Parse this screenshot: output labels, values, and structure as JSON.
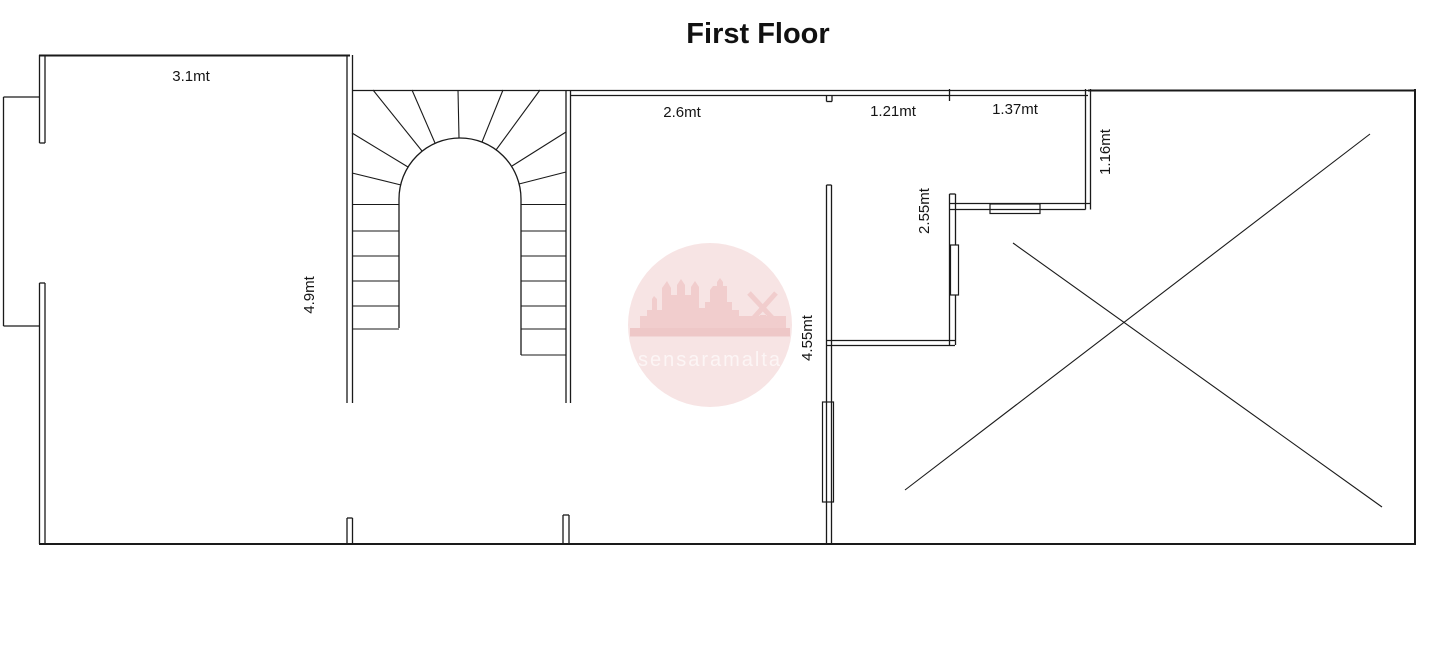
{
  "title": "First Floor",
  "plan": {
    "dimensions": {
      "left_room_width": "3.1mt",
      "left_room_height": "4.9mt",
      "middle_room_width": "2.6mt",
      "top_hall_width": "1.21mt",
      "top_bath_width": "1.37mt",
      "shaft_depth": "1.16mt",
      "bath_inner_height": "2.55mt",
      "middle_wall_height": "4.55mt"
    }
  },
  "watermark": {
    "text": "sensaramalta",
    "circle_color": "#f7e4e4",
    "silhouette_color": "#f1cdcd",
    "band_color": "#eec7c7",
    "text_color": "#fcf5f5"
  },
  "colors": {
    "background": "#ffffff",
    "line": "#1a1a1a"
  }
}
